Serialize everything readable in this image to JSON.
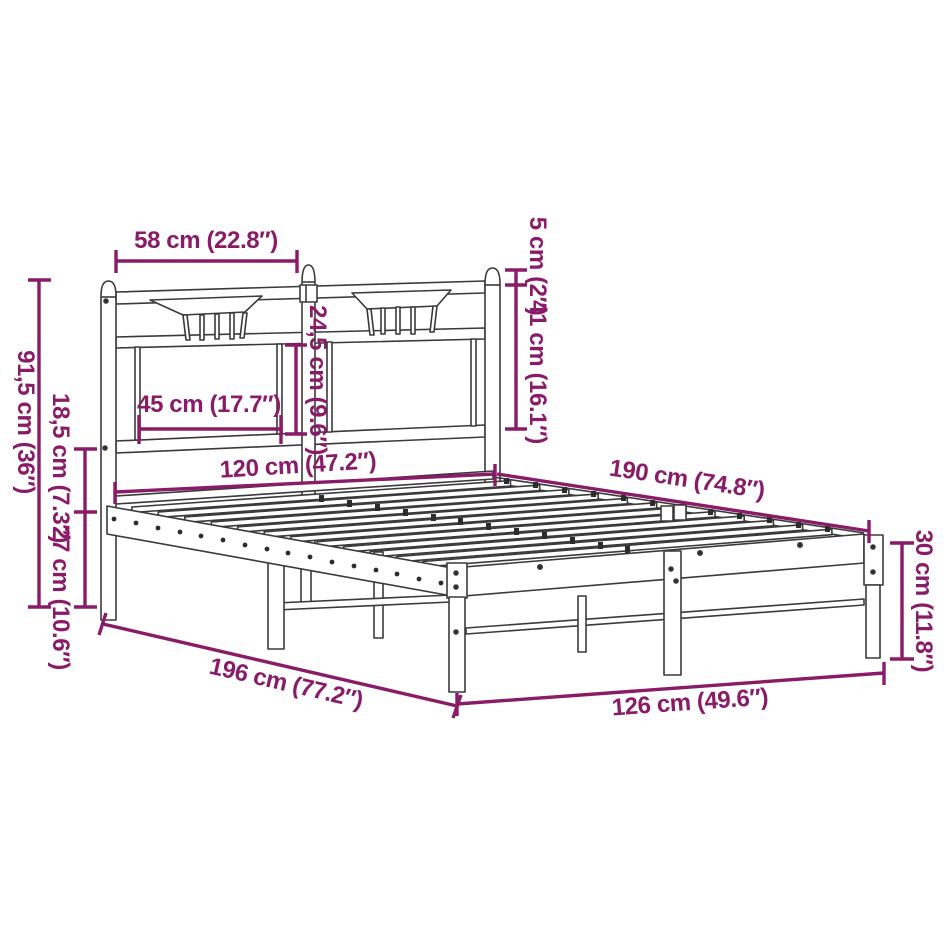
{
  "diagram": {
    "subject": "metal bed frame with headboard — dimension line drawing",
    "accent_color": "#8a1b68",
    "line_color": "#3a3a3a",
    "background_color": "#ffffff",
    "unit_system": "cm (inches)",
    "dims": {
      "d58": "58 cm (22.8″)",
      "d5": "5 cm (2″)",
      "d41": "41 cm (16.1″)",
      "d24_5": "24,5 cm (9.6″)",
      "d45": "45 cm (17.7″)",
      "d91_5": "91,5 cm (36″)",
      "d18_5": "18,5 cm (7.3″)",
      "d27": "27 cm (10.6″)",
      "d120": "120 cm (47.2″)",
      "d190": "190 cm (74.8″)",
      "d30": "30 cm (11.8″)",
      "d196": "196 cm (77.2″)",
      "d126": "126 cm (49.6″)"
    }
  }
}
